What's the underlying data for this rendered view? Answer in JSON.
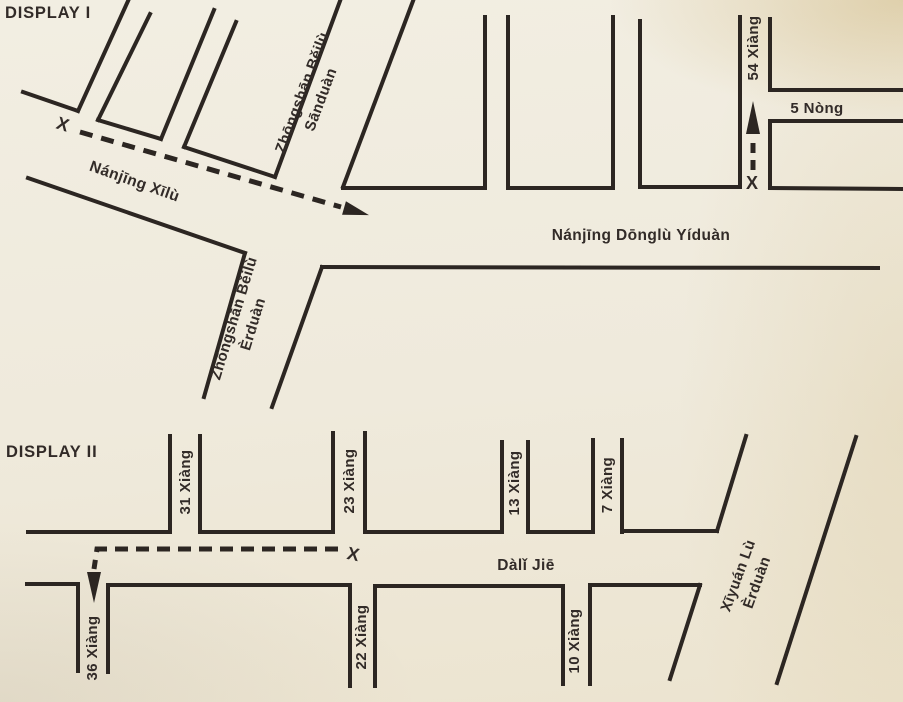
{
  "colors": {
    "ink": "#2c2622",
    "paper": "#f0ecdf"
  },
  "display1": {
    "title": "DISPLAY I",
    "start_marker": "X",
    "nanjing_xilu": "Nánjīng Xīlù",
    "zhongshan_sanduan_line1": "Zhōngshān Běilù",
    "zhongshan_sanduan_line2": "Sānduàn",
    "zhongshan_erduan_line1": "Zhōngshān Běilù",
    "zhongshan_erduan_line2": "Èrduàn",
    "nanjing_donglu": "Nánjīng Dōnglù Yíduàn",
    "xiang_54": "54 Xiàng",
    "xiang54_marker": "X",
    "nong_5": "5 Nòng"
  },
  "display2": {
    "title": "DISPLAY II",
    "start_marker": "X",
    "xiang_31": "31 Xiàng",
    "xiang_23": "23 Xiàng",
    "xiang_13": "13 Xiàng",
    "xiang_7": "7 Xiàng",
    "xiang_36": "36 Xiàng",
    "xiang_22": "22 Xiàng",
    "xiang_10": "10 Xiàng",
    "dali_jie": "Dàlǐ Jiē",
    "xiyuan_line1": "Xīyuán Lù",
    "xiyuan_line2": "Èrduàn"
  }
}
